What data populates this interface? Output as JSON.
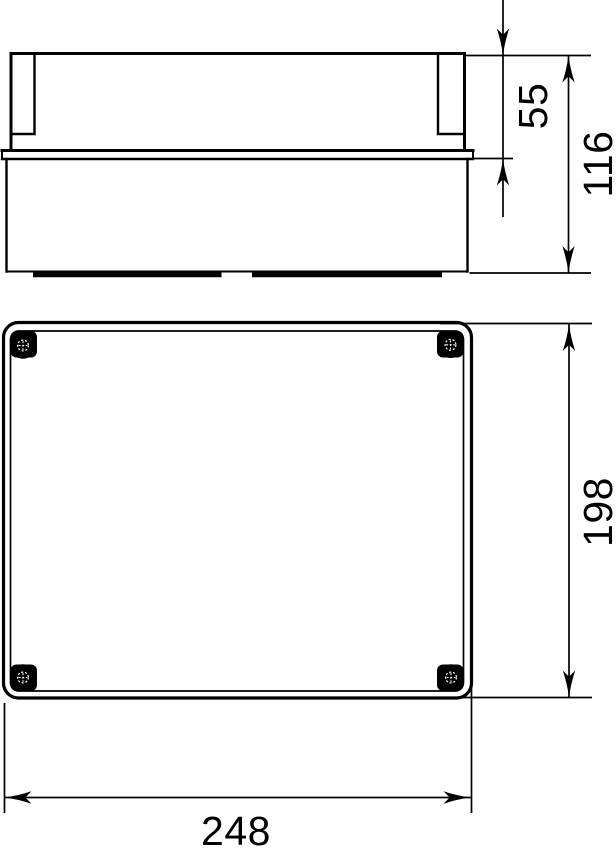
{
  "drawing": {
    "background_color": "#ffffff",
    "line_color": "#000000",
    "views": {
      "side_view": {
        "dimensions": {
          "lid_height": "55",
          "total_height": "116"
        }
      },
      "plan_view": {
        "dimensions": {
          "length": "198",
          "width": "248"
        }
      }
    }
  }
}
